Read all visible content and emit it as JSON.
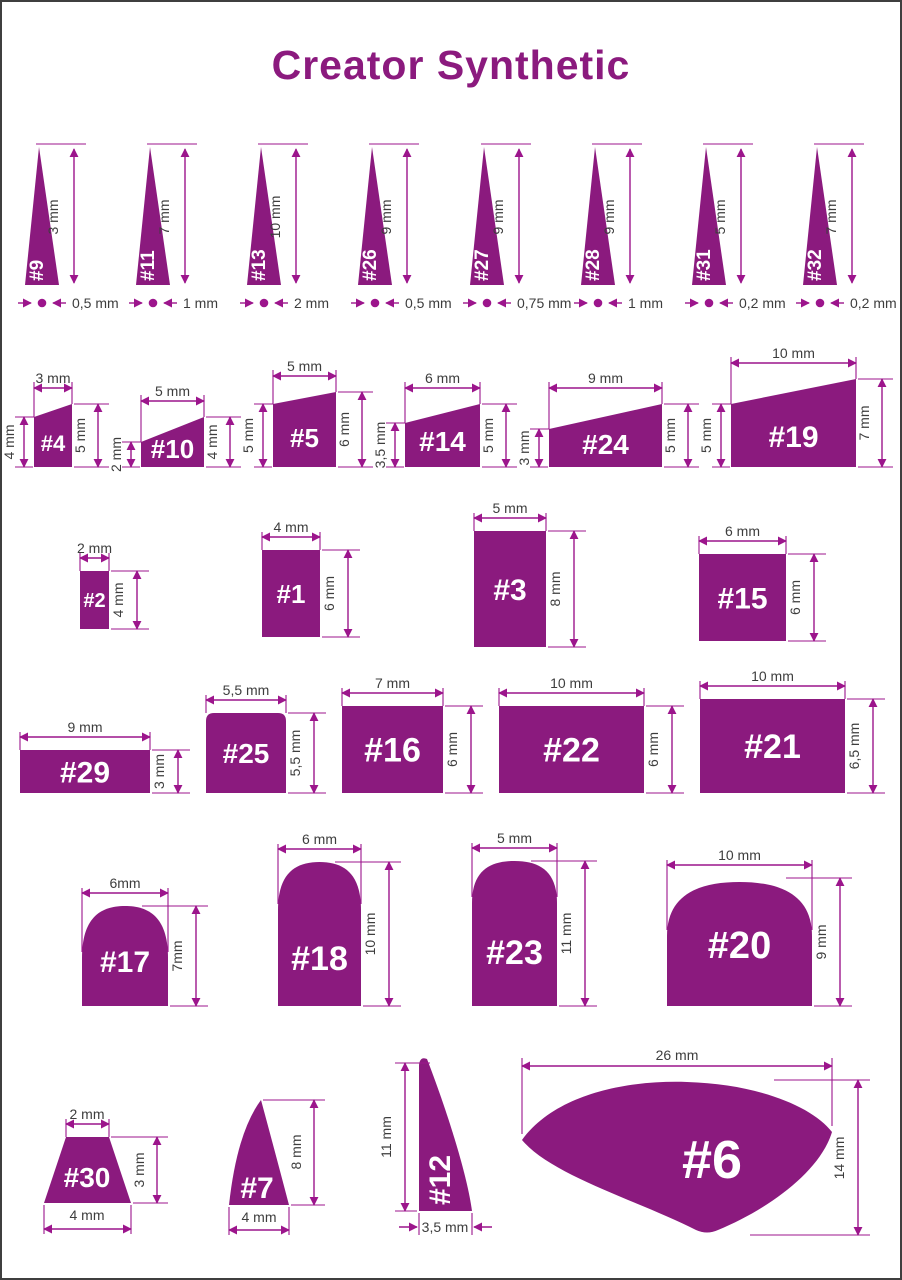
{
  "title": "Creator Synthetic",
  "colors": {
    "title": "#8B1A7E",
    "brush": "#8B1A7E",
    "dimension": "#9C158C",
    "label_text": "#3D3D3D",
    "number_text": "#FFFFFF"
  },
  "rows": [
    {
      "group": "liner-brushes",
      "items": [
        {
          "label": "#9",
          "height": "3 mm",
          "width": "0,5 mm"
        },
        {
          "label": "#11",
          "height": "7 mm",
          "width": "1 mm"
        },
        {
          "label": "#13",
          "height": "10 mm",
          "width": "2 mm"
        },
        {
          "label": "#26",
          "height": "9 mm",
          "width": "0,5 mm"
        },
        {
          "label": "#27",
          "height": "9 mm",
          "width": "0,75 mm"
        },
        {
          "label": "#28",
          "height": "9 mm",
          "width": "1 mm"
        },
        {
          "label": "#31",
          "height": "5 mm",
          "width": "0,2 mm"
        },
        {
          "label": "#32",
          "height": "7 mm",
          "width": "0,2 mm"
        }
      ]
    },
    {
      "group": "angular-brushes",
      "items": [
        {
          "label": "#4",
          "top": "3 mm",
          "left": "4 mm",
          "right": "5 mm"
        },
        {
          "label": "#10",
          "top": "5 mm",
          "left": "2 mm",
          "right": "4 mm"
        },
        {
          "label": "#5",
          "top": "5 mm",
          "left": "5 mm",
          "right": "6 mm"
        },
        {
          "label": "#14",
          "top": "6 mm",
          "left": "3,5 mm",
          "right": "5 mm"
        },
        {
          "label": "#24",
          "top": "9 mm",
          "left": "3 mm",
          "right": "5 mm"
        },
        {
          "label": "#19",
          "top": "10 mm",
          "left": "5 mm",
          "right": "7 mm"
        }
      ]
    },
    {
      "group": "flat-brushes-small",
      "items": [
        {
          "label": "#2",
          "width": "2 mm",
          "height": "4 mm"
        },
        {
          "label": "#1",
          "width": "4 mm",
          "height": "6 mm"
        },
        {
          "label": "#3",
          "width": "5 mm",
          "height": "8 mm"
        },
        {
          "label": "#15",
          "width": "6 mm",
          "height": "6 mm"
        }
      ]
    },
    {
      "group": "flat-brushes-wide",
      "items": [
        {
          "label": "#29",
          "width": "9 mm",
          "height": "3 mm"
        },
        {
          "label": "#25",
          "width": "5,5 mm",
          "height": "5,5 mm"
        },
        {
          "label": "#16",
          "width": "7 mm",
          "height": "6 mm"
        },
        {
          "label": "#22",
          "width": "10 mm",
          "height": "6 mm"
        },
        {
          "label": "#21",
          "width": "10 mm",
          "height": "6,5 mm"
        }
      ]
    },
    {
      "group": "round-top-brushes",
      "items": [
        {
          "label": "#17",
          "width": "6mm",
          "height": "7mm"
        },
        {
          "label": "#18",
          "width": "6 mm",
          "height": "10 mm"
        },
        {
          "label": "#23",
          "width": "5 mm",
          "height": "11 mm"
        },
        {
          "label": "#20",
          "width": "10 mm",
          "height": "9 mm"
        }
      ]
    },
    {
      "group": "special-brushes",
      "items": [
        {
          "label": "#30",
          "top": "2 mm",
          "height": "3 mm",
          "bottom": "4 mm"
        },
        {
          "label": "#7",
          "height": "8 mm",
          "bottom": "4 mm"
        },
        {
          "label": "#12",
          "height": "11 mm",
          "bottom": "3,5 mm"
        },
        {
          "label": "#6",
          "width": "26 mm",
          "height": "14 mm"
        }
      ]
    }
  ]
}
